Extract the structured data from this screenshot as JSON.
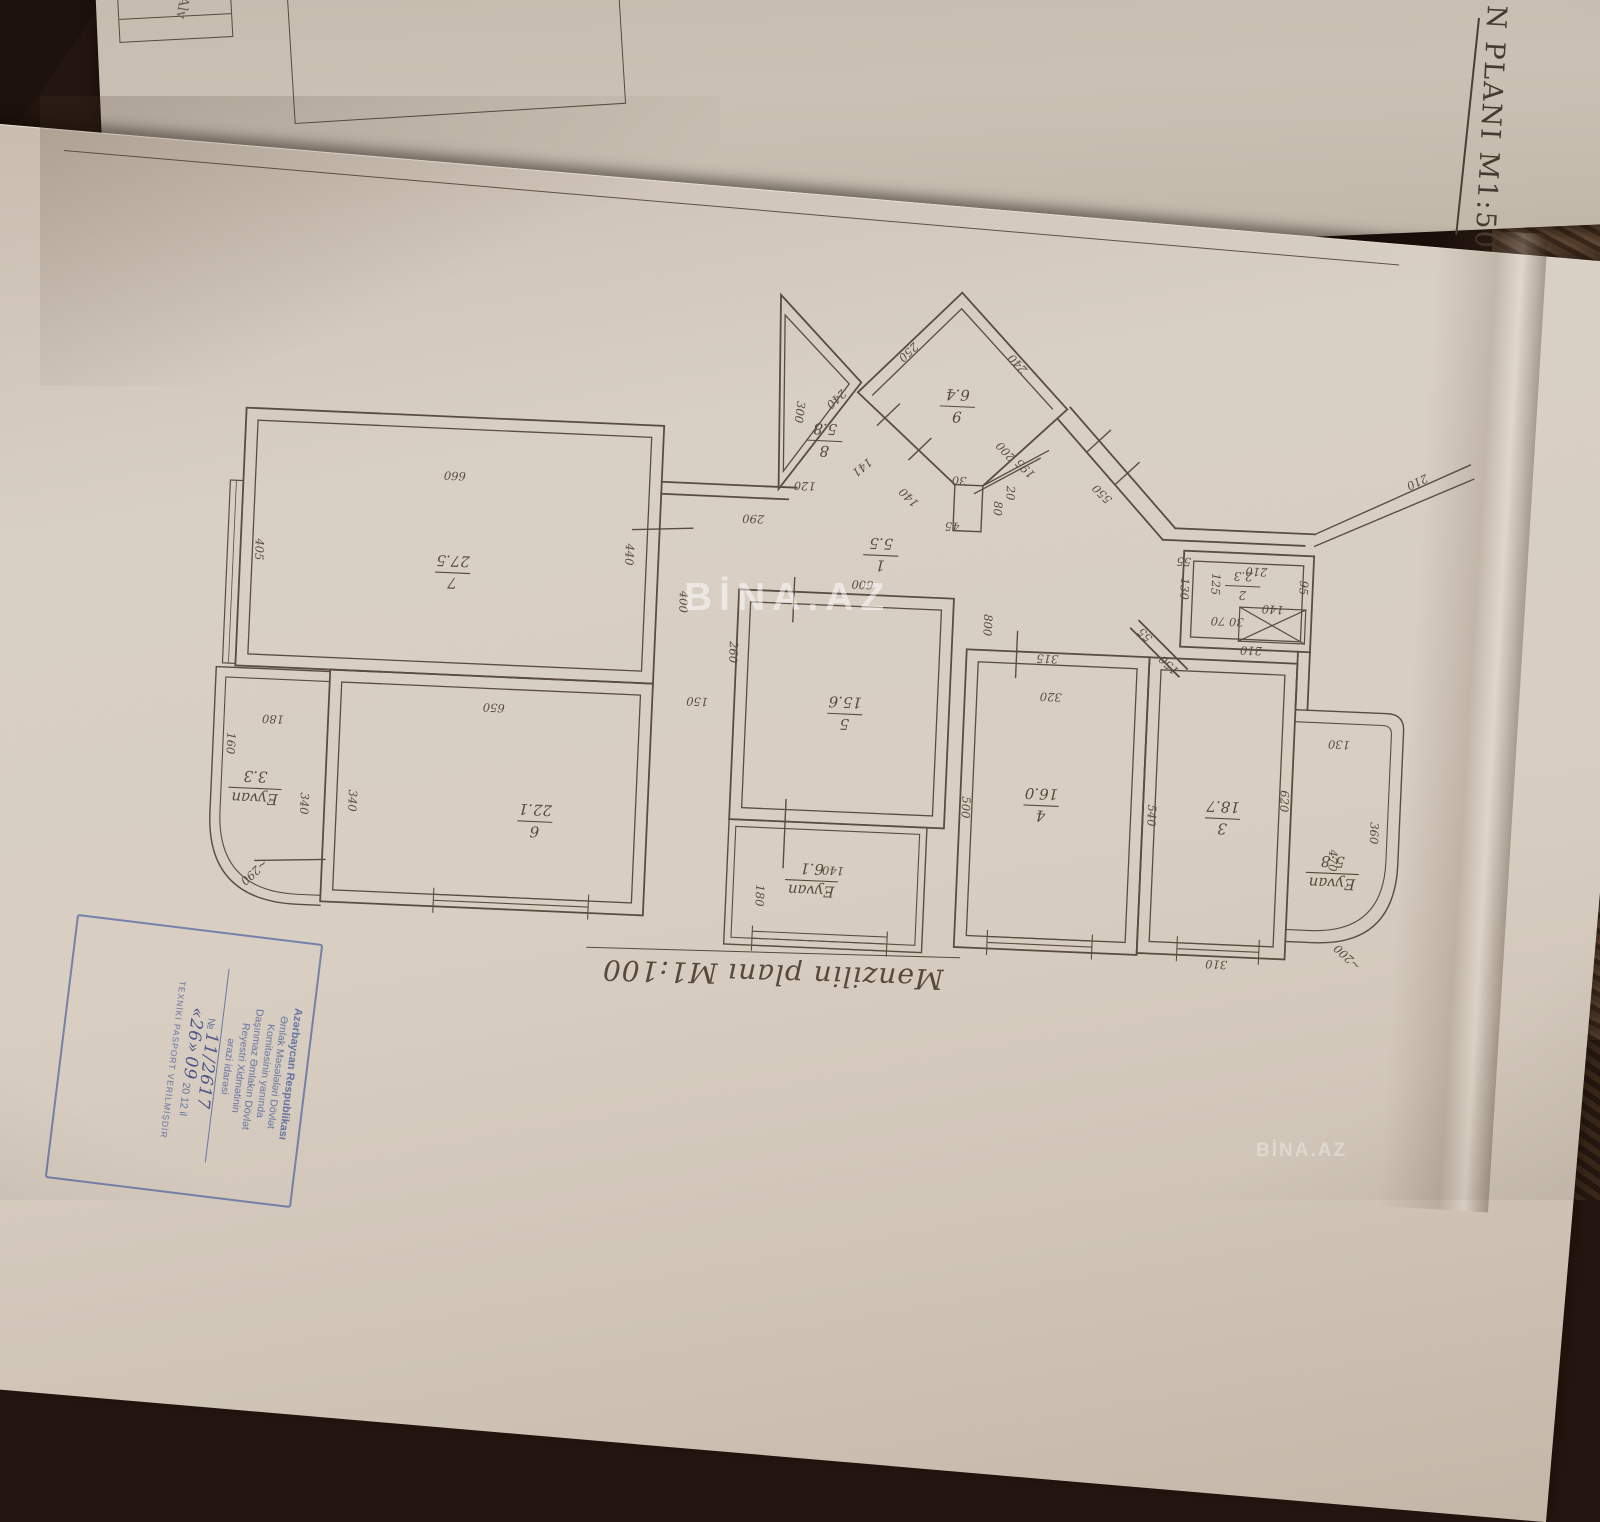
{
  "photo": {
    "back_sheet_header": "N PLANI  M1:500",
    "back_sheet_note": "Alv",
    "watermark_center": "BİNA.AZ",
    "watermark_corner": "BİNA.AZ"
  },
  "colors": {
    "ink": "#584a3c",
    "stamp_blue": "#50639e",
    "paper_front": "#d8cec2",
    "paper_back": "#c7beb1",
    "cloth_dark": "#23150f",
    "watermark": "rgba(255,255,255,0.5)"
  },
  "plan": {
    "title": "Mənzilin planı M1:100",
    "orientation_note": "plan sheet photographed upside down; labels read rotated 180°",
    "rooms": [
      {
        "num": "7",
        "area": "27.5",
        "x": 450,
        "y": 588
      },
      {
        "num": "6",
        "area": "22.1",
        "x": 543,
        "y": 833
      },
      {
        "num": "5",
        "area": "15.6",
        "x": 848,
        "y": 712
      },
      {
        "num": "4",
        "area": "16.0",
        "x": 1048,
        "y": 795
      },
      {
        "num": "3",
        "area": "18.7",
        "x": 1230,
        "y": 800
      },
      {
        "num": "1",
        "area": "5.5",
        "x": 877,
        "y": 552
      },
      {
        "num": "2",
        "area": "2.3",
        "x": 1240,
        "y": 567,
        "small": true
      },
      {
        "num": "9",
        "area": "6.4",
        "x": 947,
        "y": 400
      },
      {
        "num": "8",
        "area": "5.8",
        "x": 816,
        "y": 440
      },
      {
        "num": "Eyvan",
        "area": "3.3",
        "x": 262,
        "y": 812
      },
      {
        "num": "Eyvan",
        "area": "6.1",
        "x": 822,
        "y": 880
      },
      {
        "num": "Eyvan",
        "area": "5.8",
        "x": 1342,
        "y": 850
      }
    ],
    "dimensions": [
      {
        "v": "660",
        "x": 448,
        "y": 487,
        "r": 180
      },
      {
        "v": "405",
        "x": 252,
        "y": 573,
        "r": 90
      },
      {
        "v": "650",
        "x": 497,
        "y": 717,
        "r": 180
      },
      {
        "v": "290",
        "x": 748,
        "y": 517,
        "r": 180
      },
      {
        "v": "400",
        "x": 678,
        "y": 607,
        "r": 90
      },
      {
        "v": "440",
        "x": 622,
        "y": 562,
        "r": 90
      },
      {
        "v": "260",
        "x": 730,
        "y": 655,
        "r": 90
      },
      {
        "v": "150",
        "x": 700,
        "y": 702,
        "r": 180
      },
      {
        "v": "600",
        "x": 860,
        "y": 578,
        "r": 180
      },
      {
        "v": "800",
        "x": 983,
        "y": 617,
        "r": 90
      },
      {
        "v": "500",
        "x": 969,
        "y": 800,
        "r": 90
      },
      {
        "v": "140",
        "x": 843,
        "y": 865,
        "r": 180
      },
      {
        "v": "180",
        "x": 767,
        "y": 897,
        "r": 90
      },
      {
        "v": "340",
        "x": 308,
        "y": 825,
        "r": 90
      },
      {
        "v": "340",
        "x": 356,
        "y": 820,
        "r": 90
      },
      {
        "v": "180",
        "x": 277,
        "y": 738,
        "r": 180
      },
      {
        "v": "160",
        "x": 232,
        "y": 768,
        "r": 90
      },
      {
        "v": "~290",
        "x": 262,
        "y": 893,
        "r": 135
      },
      {
        "v": "315",
        "x": 1048,
        "y": 644,
        "r": 180
      },
      {
        "v": "320",
        "x": 1053,
        "y": 682,
        "r": 180
      },
      {
        "v": "540",
        "x": 1155,
        "y": 800,
        "r": 90
      },
      {
        "v": "620",
        "x": 1287,
        "y": 780,
        "r": 90
      },
      {
        "v": "310",
        "x": 1230,
        "y": 942,
        "r": 180
      },
      {
        "v": "130",
        "x": 1343,
        "y": 717,
        "r": 180
      },
      {
        "v": "360",
        "x": 1378,
        "y": 808,
        "r": 90
      },
      {
        "v": "470",
        "x": 1338,
        "y": 837,
        "r": 90
      },
      {
        "v": "~200",
        "x": 1363,
        "y": 930,
        "r": 220
      },
      {
        "v": "250",
        "x": 893,
        "y": 345,
        "r": 135
      },
      {
        "v": "240",
        "x": 1008,
        "y": 352,
        "r": 225
      },
      {
        "v": "240",
        "x": 823,
        "y": 395,
        "r": 135
      },
      {
        "v": "200",
        "x": 1000,
        "y": 440,
        "r": 225
      },
      {
        "v": "195",
        "x": 1020,
        "y": 456,
        "r": 222
      },
      {
        "v": "550",
        "x": 1098,
        "y": 478,
        "r": 222
      },
      {
        "v": "300",
        "x": 786,
        "y": 412,
        "r": 95
      },
      {
        "v": "120",
        "x": 798,
        "y": 482,
        "r": 180
      },
      {
        "v": "141",
        "x": 852,
        "y": 462,
        "r": 138
      },
      {
        "v": "140",
        "x": 905,
        "y": 490,
        "r": 222
      },
      {
        "v": "30",
        "x": 952,
        "y": 470,
        "r": 180
      },
      {
        "v": "80",
        "x": 988,
        "y": 500,
        "r": 90
      },
      {
        "v": "45",
        "x": 947,
        "y": 516,
        "r": 180
      },
      {
        "v": "20",
        "x": 1000,
        "y": 484,
        "r": 90
      },
      {
        "v": "55",
        "x": 1180,
        "y": 541,
        "r": 180
      },
      {
        "v": "130",
        "x": 1178,
        "y": 572,
        "r": 90
      },
      {
        "v": "125",
        "x": 1209,
        "y": 566,
        "r": 90
      },
      {
        "v": "210",
        "x": 1253,
        "y": 548,
        "r": 180
      },
      {
        "v": "95",
        "x": 1297,
        "y": 566,
        "r": 90
      },
      {
        "v": "140",
        "x": 1271,
        "y": 585,
        "r": 180
      },
      {
        "v": "30 70",
        "x": 1226,
        "y": 599,
        "r": 180
      },
      {
        "v": "210",
        "x": 1251,
        "y": 627,
        "r": 180
      },
      {
        "v": "55",
        "x": 1147,
        "y": 617,
        "r": 222
      },
      {
        "v": "150",
        "x": 1172,
        "y": 646,
        "r": 222
      },
      {
        "v": "210",
        "x": 1408,
        "y": 452,
        "r": 152
      }
    ]
  },
  "stamp": {
    "lines": [
      "Azərbaycan Respublikası",
      "Əmlak Məsələləri Dövlət",
      "Komitəsinin yanında",
      "Daşınmaz Əmlakın Dövlət",
      "Reyestri Xidmətinin",
      "ərazi idarəsi"
    ],
    "number_label": "№",
    "number": "11/2617",
    "date_day": "«26»",
    "date_month": "09",
    "date_year": "20 12 il",
    "footer": "TEXNİKİ PASPORT VERİLMİŞDİR"
  }
}
